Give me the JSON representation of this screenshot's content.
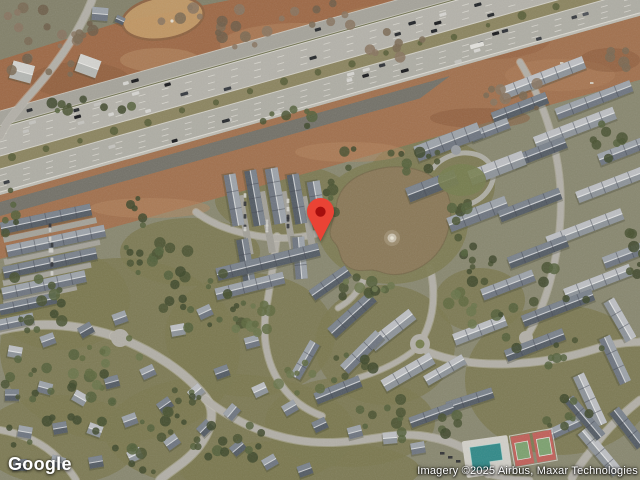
{
  "map": {
    "view_type": "satellite",
    "logo": "Google",
    "attribution": "Imagery ©2025 Airbus, Maxar Technologies",
    "marker": {
      "name": "location-pin",
      "color": "#EA4335",
      "dot_color": "#A50E0E",
      "tip_x_px": 321,
      "tip_y_px": 240
    },
    "features": {
      "highway": "multi-lane freeway running diagonally across upper portion",
      "pond_color": "#8C7A58",
      "sediment_basin_color": "#C69C67",
      "pool_color": "#2E8C8C",
      "tennis_court_color": "#C4605A",
      "dirt_color": "#A06945",
      "grass_color": "#7B7A50",
      "pavement_color": "#B7B6AE",
      "roof_dark_color": "#525B66",
      "roof_light_color": "#8F969D"
    }
  }
}
